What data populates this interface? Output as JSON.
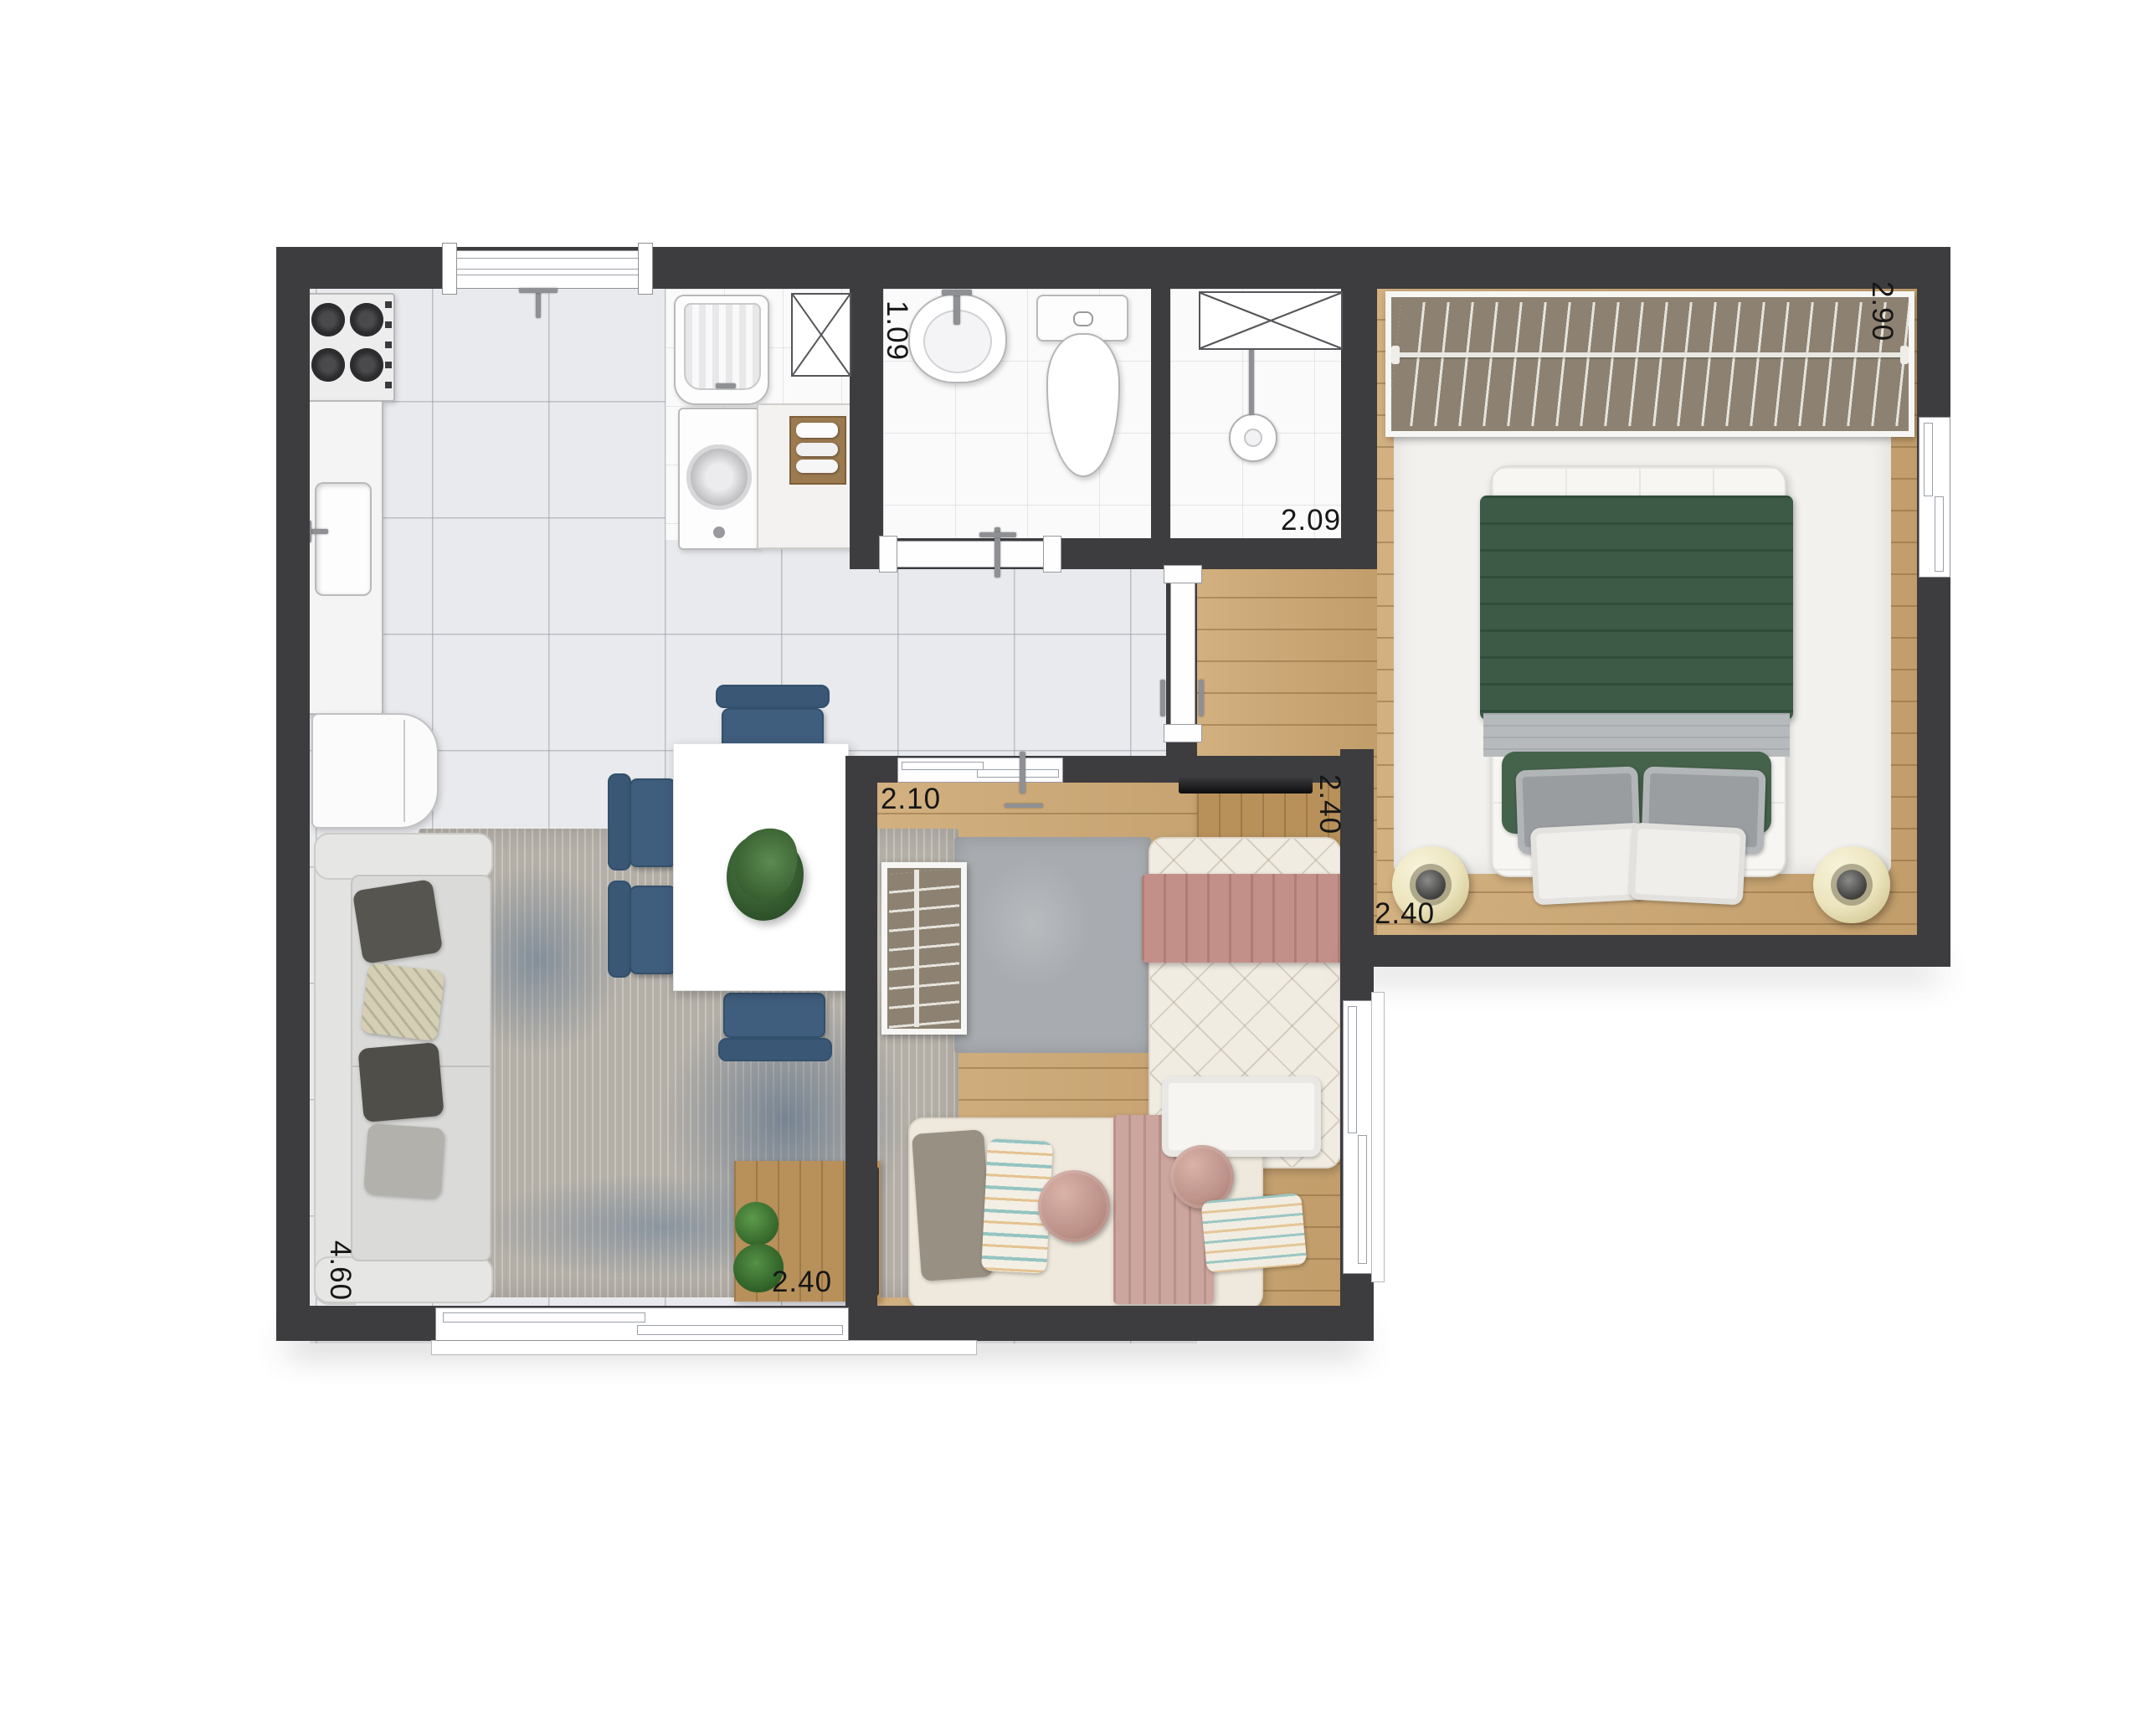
{
  "dimension_labels": {
    "bathroom_width": {
      "value": "1.09"
    },
    "shower_room_width": {
      "value": "2.09"
    },
    "master_closet_length": {
      "value": "2.90"
    },
    "bedroom2_width": {
      "value": "2.10"
    },
    "bedroom2_depth": {
      "value": "2.40"
    },
    "master_bedroom_width": {
      "value": "2.40"
    },
    "living_room_width": {
      "value": "2.40"
    },
    "living_room_length": {
      "value": "4.60"
    }
  },
  "colors": {
    "wall": "#3d3c3e",
    "tile": "#e9eaed",
    "wood-floor": "#cda771",
    "wood-furniture": "#b8905a",
    "closet-interior": "#8d8272",
    "chair-blue": "#3f5d7c",
    "blanket-green": "#3c5a45",
    "blanket-rose": "#c39089",
    "pouf-cream": "#efe9cc",
    "dim-text": "#161616"
  }
}
